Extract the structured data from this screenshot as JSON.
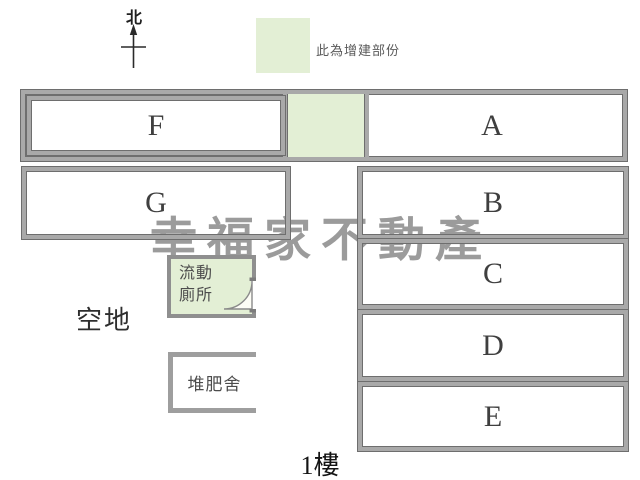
{
  "north": {
    "label": "北"
  },
  "legend": {
    "swatch_color": "#e3efd5",
    "text": "此為增建部份"
  },
  "rooms": {
    "f": "F",
    "a": "A",
    "g": "G",
    "b": "B",
    "c": "C",
    "d": "D",
    "e": "E"
  },
  "annotations": {
    "open_space": "空地",
    "portable_toilet_line1": "流動",
    "portable_toilet_line2": "廁所",
    "compost_shed": "堆肥舍",
    "floor": "1樓"
  },
  "watermark": {
    "text": "幸福家不動產",
    "color": "#9b9b9b"
  },
  "colors": {
    "extension_green": "#e3efd5",
    "wall_gray": "#a9a9a9",
    "wall_outline": "#6e6e6e"
  }
}
